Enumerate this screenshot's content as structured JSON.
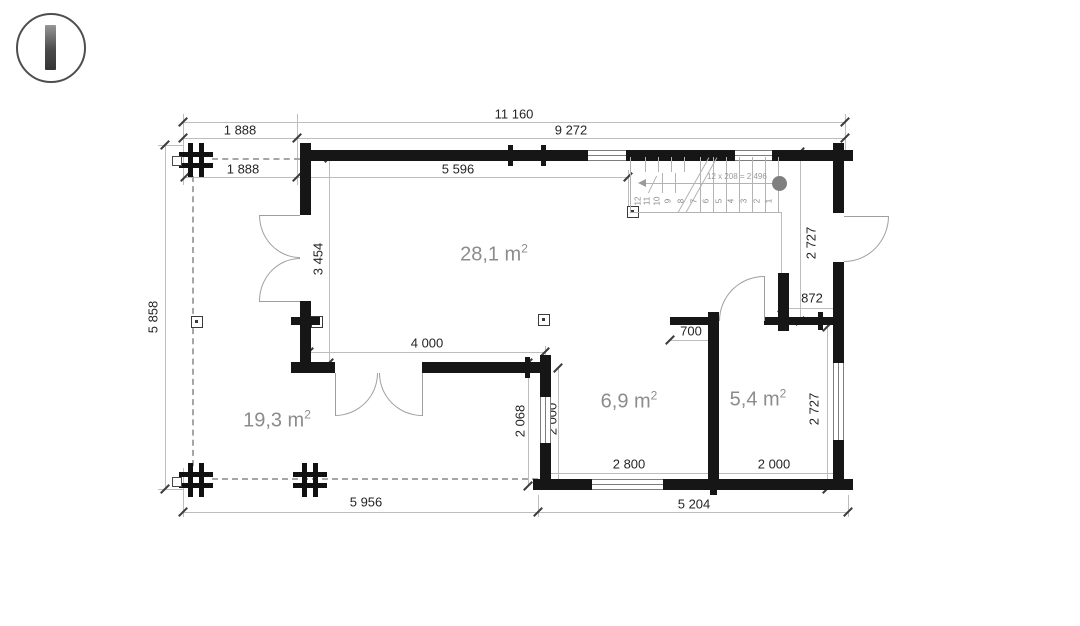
{
  "logo": {
    "description": "circle-with-vertical-bar"
  },
  "colors": {
    "wall": "#161616",
    "dimension_line": "#bdbdbd",
    "dimension_text": "#252525",
    "room_label": "#8c8c8c",
    "stair_line": "#b3b3b3",
    "start_dot": "#7f7f7f"
  },
  "dims": {
    "total_width": "11 160",
    "terrace_width_top": "1 888",
    "building_width": "9 272",
    "terrace_width_top2": "1 888",
    "front_wall_run": "5 596",
    "side_height": "5 858",
    "left_door_span": "3 454",
    "living_door_span": "4 000",
    "hall_span": "2 068",
    "hall_clear": "2 000",
    "vestibule_depth": "700",
    "entry_width": "872",
    "right_upper": "2 727",
    "right_lower": "2 727",
    "room_a_width": "2 800",
    "room_b_width": "2 000",
    "terrace_bottom_width": "5 956",
    "bottom_right_width": "5 204"
  },
  "rooms": {
    "living": {
      "text": "28,1 m",
      "sup": "2"
    },
    "terrace": {
      "text": "19,3 m",
      "sup": "2"
    },
    "hall": {
      "text": "6,9 m",
      "sup": "2"
    },
    "bedroom": {
      "text": "5,4 m",
      "sup": "2"
    }
  },
  "stairs": {
    "run_label": "12 x 208 = 2 496",
    "steps": [
      "1",
      "2",
      "3",
      "4",
      "5",
      "6",
      "7",
      "8",
      "9",
      "10",
      "11",
      "12"
    ]
  }
}
